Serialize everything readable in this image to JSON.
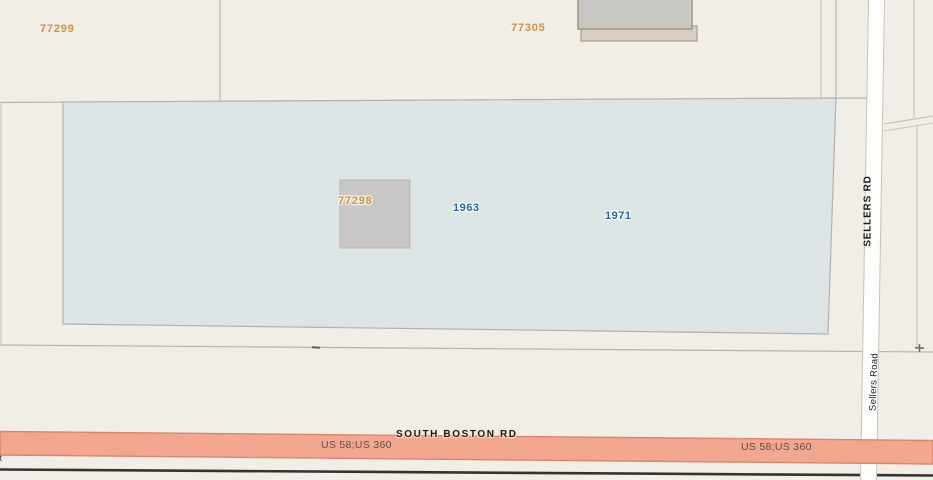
{
  "map": {
    "labels": {
      "parcel_77299": "77299",
      "parcel_77305": "77305",
      "parcel_77298": "77298",
      "address_1963": "1963",
      "address_1971": "1971",
      "sellers_rd": "SELLERS RD",
      "sellers_road": "Sellers Road",
      "south_boston_rd": "SOUTH BOSTON RD",
      "us58_us360_left": "US 58;US 360",
      "us58_us360_right": "US 58;US 360",
      "scale_unit": "ft"
    },
    "colors": {
      "background": "#f1eee7",
      "highlighted_parcel_fill": "#dce4e6",
      "parcel_line": "#bcb8b0",
      "parcel_label_text": "#cc9140",
      "address_label_text": "#2a639e",
      "highway_fill": "#f3a78e",
      "highway_border": "#d8876c",
      "local_road_fill": "#fdfdfc",
      "building_fill": "#c8c7c4",
      "building_outline": "#a39584",
      "building_porch_fill": "#d9d0c3",
      "frame_line": "#333330"
    }
  }
}
